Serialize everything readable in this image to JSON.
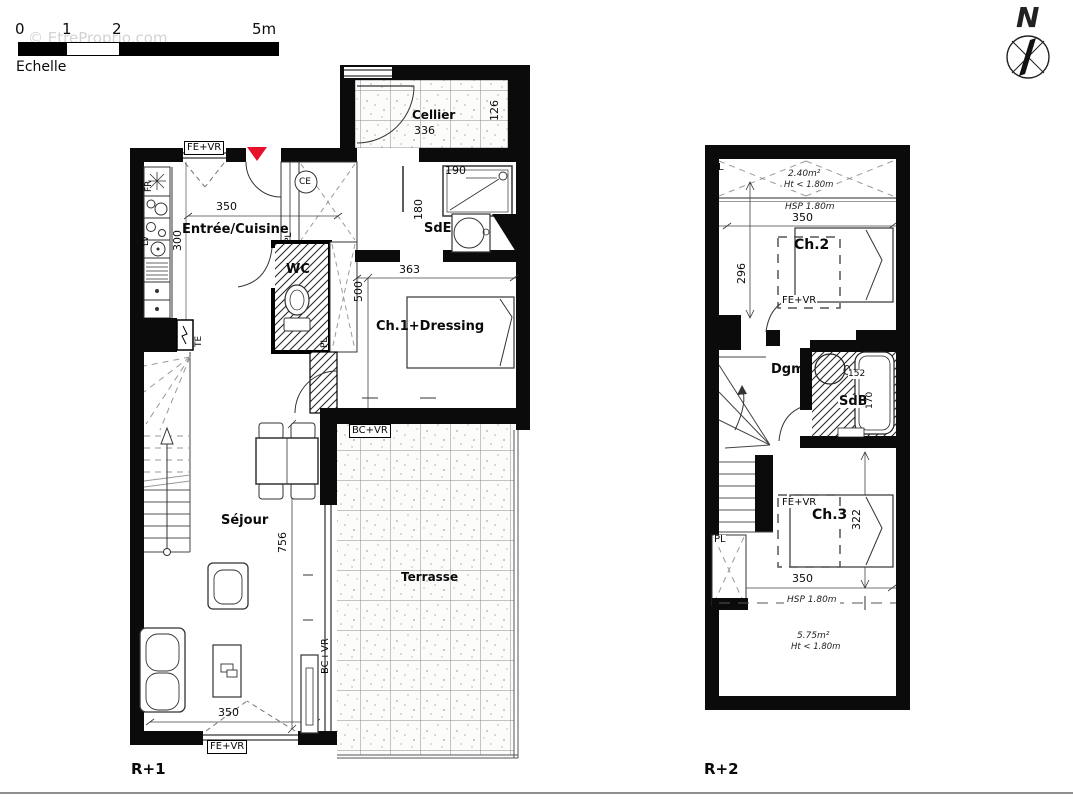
{
  "watermark": "© EtreProprio.com",
  "scale": {
    "ticks": [
      "0",
      "1",
      "2",
      "5m"
    ],
    "label": "Echelle"
  },
  "compass": {
    "north": "N"
  },
  "colors": {
    "wall": "#0b0b0b",
    "entrance_marker": "#e8112d",
    "hatch": "#2a2a2a",
    "dash": "#8a8a8a"
  },
  "r1": {
    "floor_label": "R+1",
    "rooms": {
      "cellier": "Cellier",
      "entree_cuisine": "Entrée/Cuisine",
      "wc": "WC",
      "sde": "SdE",
      "ch1": "Ch.1+Dressing",
      "sejour": "Séjour",
      "terrasse": "Terrasse"
    },
    "dims": {
      "cellier_w": "336",
      "cellier_d": "126",
      "entree_w": "350",
      "kitchen_l": "300",
      "shower_w": "190",
      "sde_d": "180",
      "ch1_w": "363",
      "ch1_l": "500",
      "sejour_l": "756",
      "sejour_w": "350"
    },
    "tags": {
      "window_top": "FE+VR",
      "window_bottom": "FE+VR",
      "bay_ch1": "BC+VR",
      "bay_sejour": "BC+VR",
      "closet_hall": "PL",
      "closet_ch1": "PL",
      "water_heater": "CE",
      "fridge": "FR",
      "dishwasher": "LV",
      "elec_panel": "TE"
    }
  },
  "r2": {
    "floor_label": "R+2",
    "rooms": {
      "ch2": "Ch.2",
      "ch3": "Ch.3",
      "dgmt": "Dgmt",
      "sdb": "SdB"
    },
    "dims": {
      "ch2_w": "350",
      "ch2_l": "296",
      "sdb_w": "152",
      "sdb_l": "170",
      "ch3_l": "322",
      "ch3_w": "350"
    },
    "tags": {
      "closet_top": "PL",
      "closet_bottom": "PL",
      "roof_window_ch2": "FE+VR",
      "roof_window_ch3": "FE+VR"
    },
    "notes": {
      "attic_top_area": "2.40m²",
      "attic_top_height": "Ht < 1.80m",
      "hsp_top": "HSP 1.80m",
      "hsp_bottom": "HSP 1.80m",
      "attic_bottom_area": "5.75m²",
      "attic_bottom_height": "Ht < 1.80m"
    }
  }
}
